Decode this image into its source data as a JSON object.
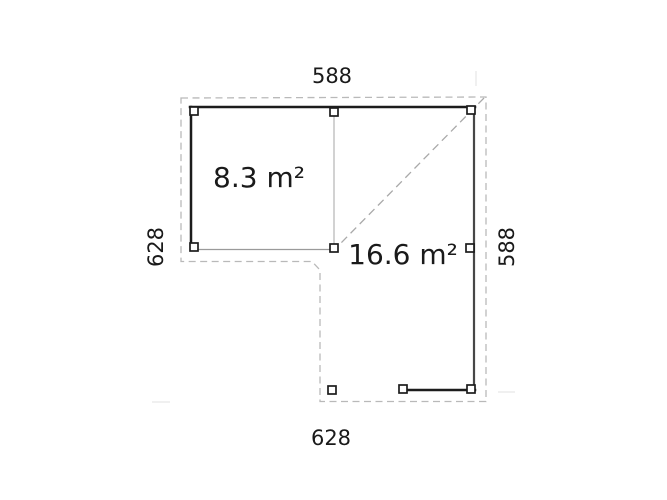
{
  "plan": {
    "name": "floor-plan",
    "dimensions": {
      "top": "588",
      "bottom": "628",
      "left": "628",
      "right": "588"
    },
    "areas": {
      "left_room": "8.3 m²",
      "right_room": "16.6 m²"
    },
    "colors": {
      "background": "#ffffff",
      "wall": "#1c1c1c",
      "wall_light": "#474747",
      "roof_dash": "#b9b9b9",
      "diagonal_dash": "#a9a9a9",
      "interior_line": "#9a9a9a",
      "partition_line": "#b3b3b3",
      "post_stroke": "#1c1c1c",
      "post_fill": "#ffffff",
      "text": "#1a1a1a",
      "faint_tick": "#e6e6e6"
    }
  }
}
